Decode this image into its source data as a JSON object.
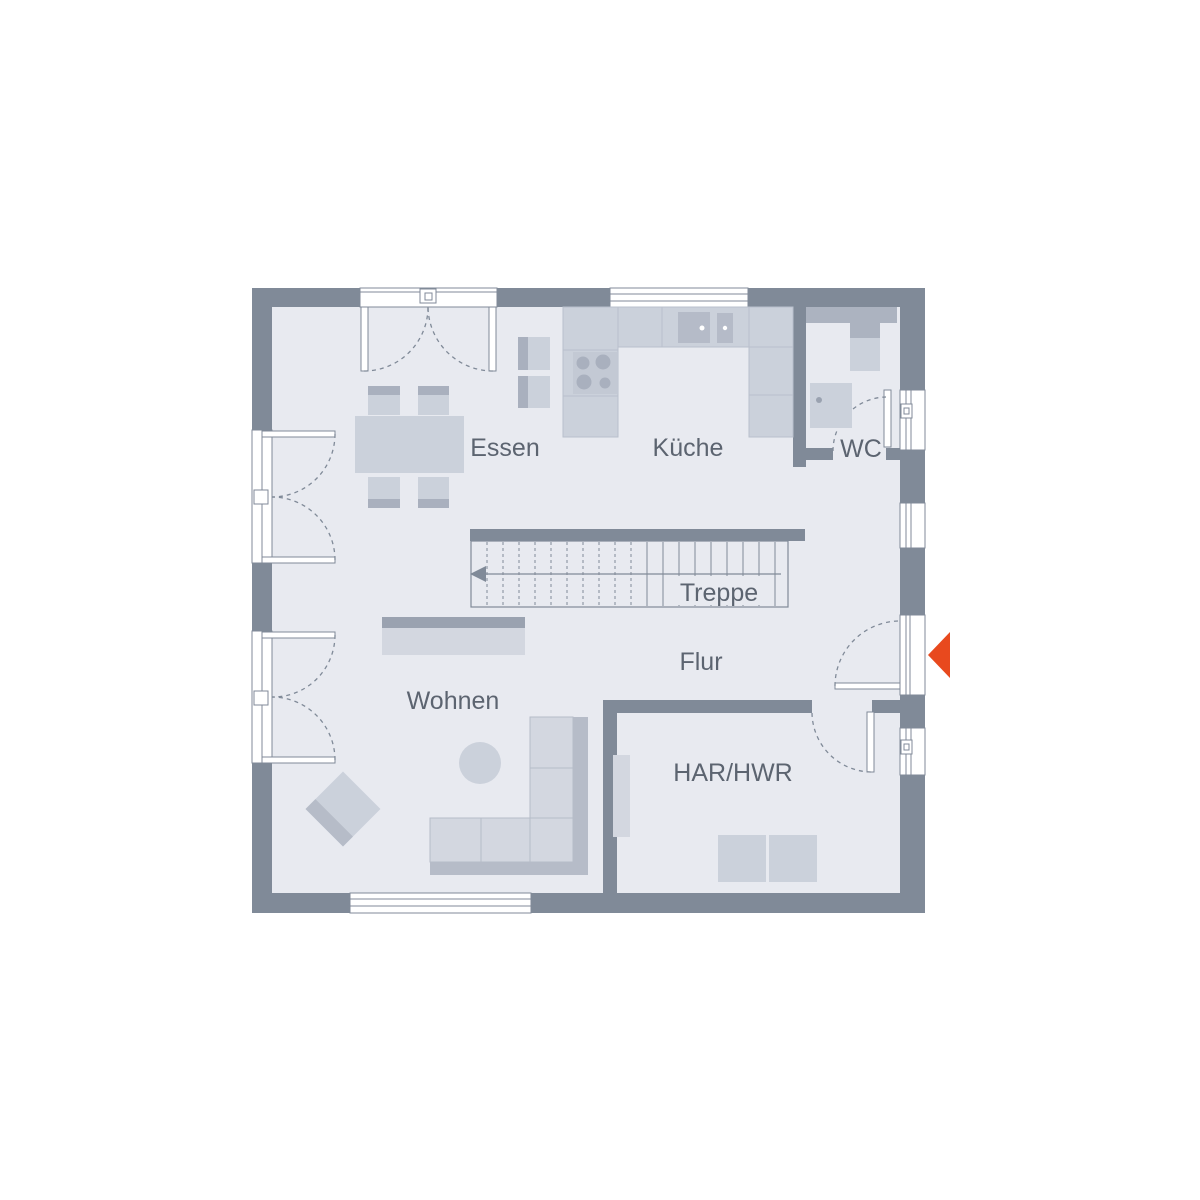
{
  "floorplan": {
    "rooms": {
      "essen": {
        "label": "Essen"
      },
      "kueche": {
        "label": "Küche"
      },
      "wc": {
        "label": "WC"
      },
      "treppe": {
        "label": "Treppe"
      },
      "flur": {
        "label": "Flur"
      },
      "wohnen": {
        "label": "Wohnen"
      },
      "har_hwr": {
        "label": "HAR/HWR"
      }
    },
    "icons": {
      "entrance_marker": "left-arrow-triangle"
    },
    "colors": {
      "wall": "#808A98",
      "floor": "#E8EAF0",
      "line": "#808A98",
      "furn_light": "#D3D7E0",
      "furn_mid": "#CBD1DB",
      "furn_dark": "#A9B0BE",
      "furn_darker": "#9AA2B0",
      "sofa_back": "#B6BCC8",
      "wc_counter": "#ACB3C0",
      "sink_dark": "#B5BBC8",
      "label": "#5C6470",
      "accent": "#E8491E",
      "bg": "#FFFFFF"
    }
  }
}
